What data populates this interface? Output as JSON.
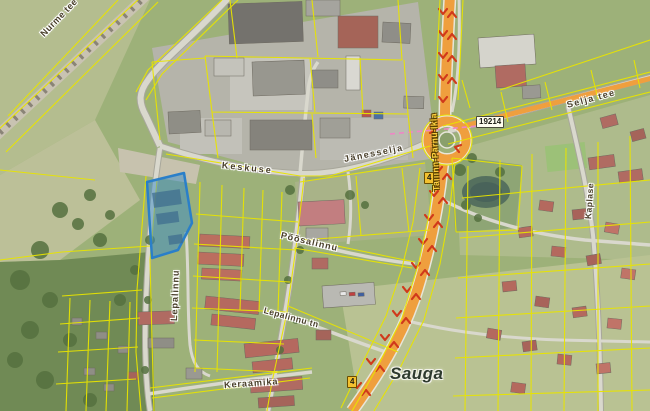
{
  "map": {
    "place_labels": [
      {
        "id": "sauga",
        "text": "Sauga"
      }
    ],
    "street_labels": [
      {
        "id": "nurme-tee",
        "text": "Nurme tee"
      },
      {
        "id": "keskuse",
        "text": "Keskuse"
      },
      {
        "id": "janesselja",
        "text": "Jänesselja"
      },
      {
        "id": "highway-name",
        "text": "Tallinn-Pärnu-Ikla"
      },
      {
        "id": "selja-tee",
        "text": "Selja tee"
      },
      {
        "id": "lepalinnu",
        "text": "Lepalinnu"
      },
      {
        "id": "poosalinnu",
        "text": "Põõsalinnu"
      },
      {
        "id": "lepalinnu-tn",
        "text": "Lepalinnu tn"
      },
      {
        "id": "keraamika",
        "text": "Keraamika"
      },
      {
        "id": "kaplase",
        "text": "Kaplase"
      }
    ],
    "road_badges": [
      {
        "id": "badge-4-north",
        "text": "4"
      },
      {
        "id": "badge-4-south",
        "text": "4"
      },
      {
        "id": "badge-19214",
        "text": "19214"
      }
    ],
    "selected_parcel": {
      "status": "highlighted",
      "outline_color": "#2a7fc9",
      "fill_color": "rgba(58,140,200,0.5)"
    },
    "legend_colors": {
      "cadastral_boundary": "#e8e400",
      "main_road": "#ef9f3e",
      "traffic_arrow": "#d0391b",
      "aerial_field": "#9db179"
    }
  }
}
